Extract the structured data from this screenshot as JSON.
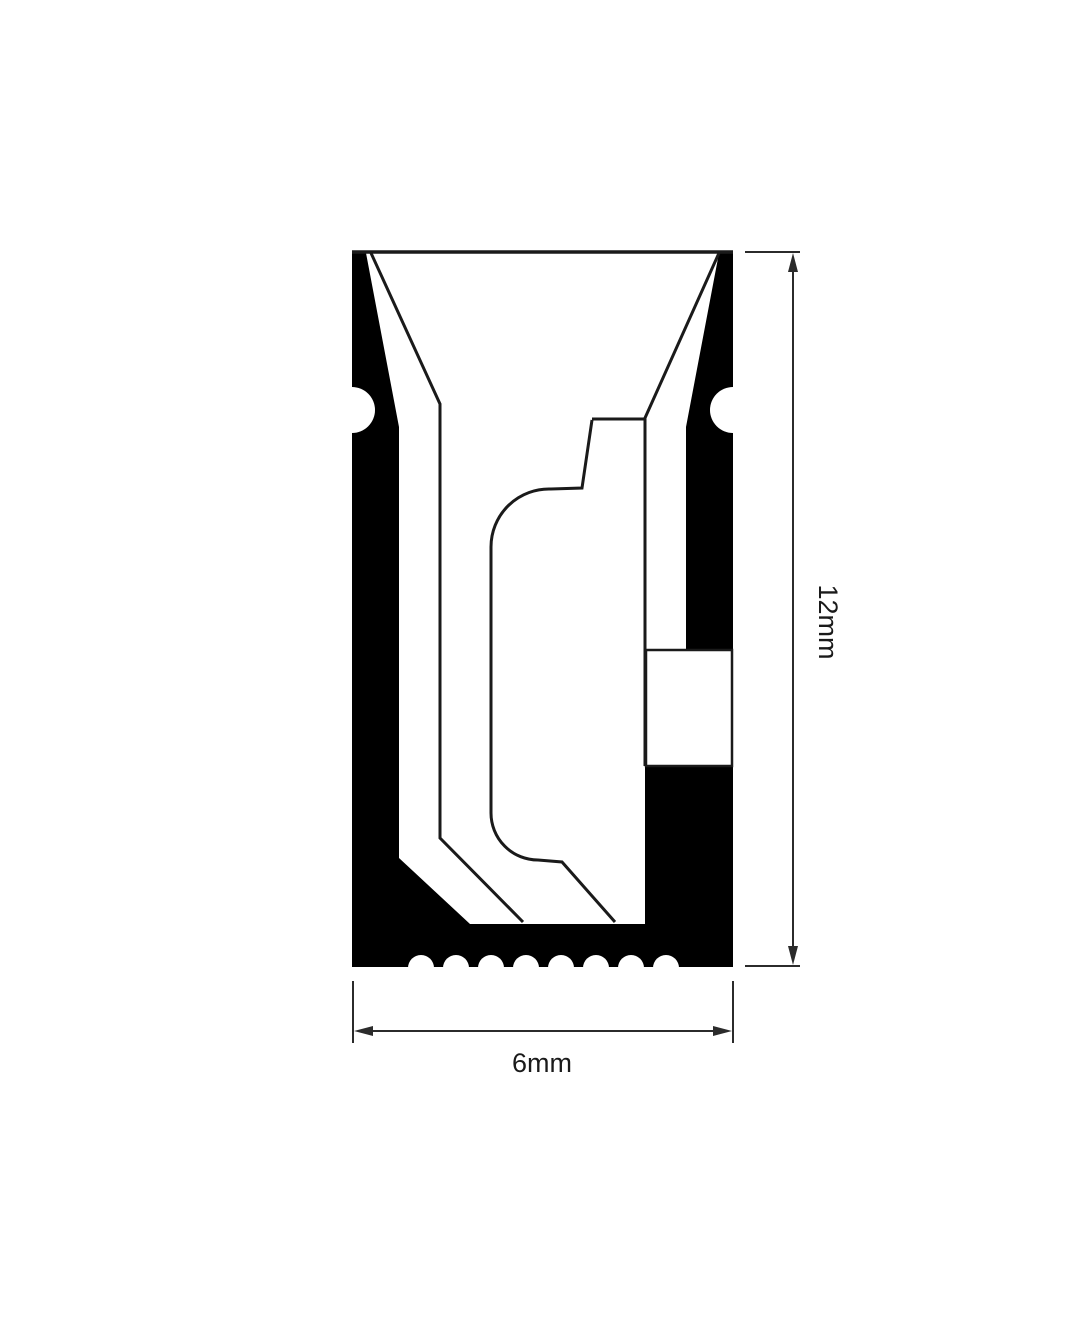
{
  "page": {
    "background": "#ffffff"
  },
  "diagram": {
    "type": "technical-cross-section-profile",
    "dimensions": {
      "height": {
        "label": "12mm"
      },
      "width": {
        "label": "6mm"
      }
    },
    "colors": {
      "body_fill": "#000000",
      "cavity_fill": "#ffffff",
      "outline_stroke": "#1a1a1a",
      "dimension_stroke": "#2b2b2b",
      "background": "#ffffff"
    },
    "features": {
      "side_mounting_notches": 2,
      "bottom_grip_ridges": 8
    }
  }
}
